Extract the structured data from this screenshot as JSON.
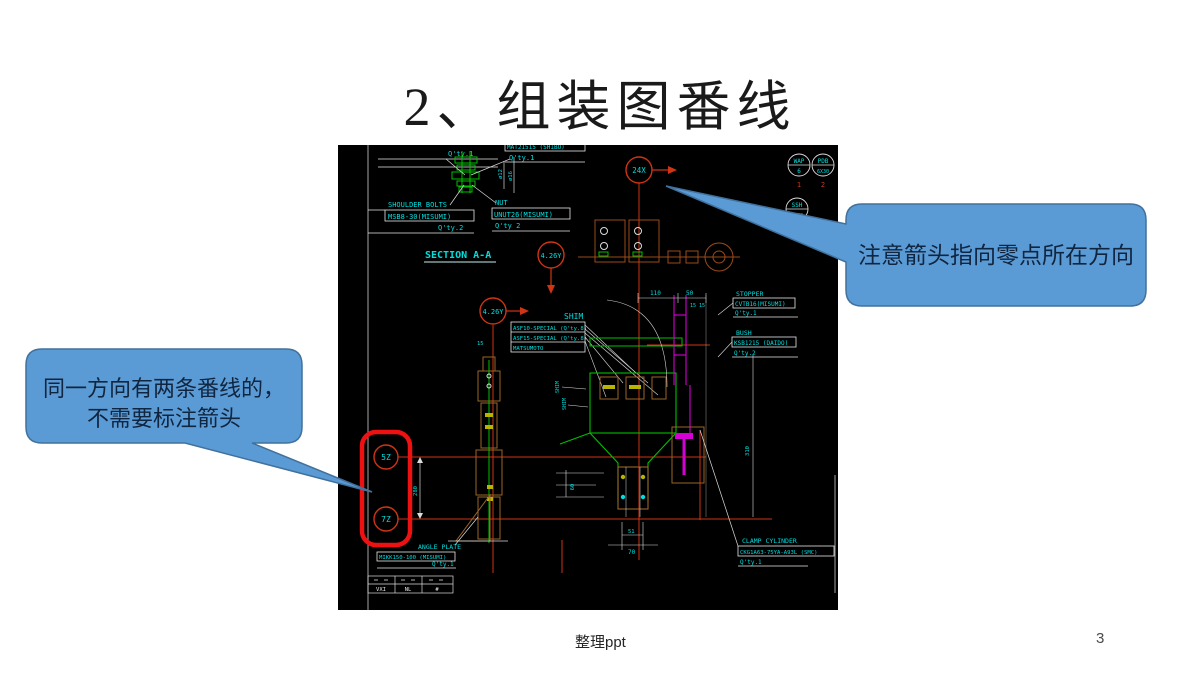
{
  "slide": {
    "title": "2、组装图番线",
    "footer_left": "整理ppt",
    "page_number": "3"
  },
  "callouts": {
    "fill": "#5b9bd5",
    "border": "#41719c",
    "right_text": "注意箭头指向零点所在方向",
    "left_line1": "同一方向有两条番线的，",
    "left_line2": "不需要标注箭头"
  },
  "cad": {
    "colors": {
      "cyan": "#00dede",
      "green": "#00c000",
      "red": "#cf3415",
      "highlight_red": "#ee1111",
      "magenta": "#d400d4",
      "tan": "#9a6428",
      "white": "#e8e8e8"
    },
    "section_label": "SECTION A-A",
    "top_left_qty": "Q'ty.1",
    "top_right_name": "MAT21515 (SHIBO)",
    "top_right_qty": "Q'ty.1",
    "shoulder_bolts": [
      "SHOULDER BOLTS",
      "MSB8-30(MISUMI)",
      "Q'ty.2"
    ],
    "nut": [
      "NUT",
      "UNUT26(MISUMI)",
      "Q'ty 2"
    ],
    "shim_title": "SHIM",
    "shim_rows": [
      "ASF10-SPECIAL (Q'ty.8)",
      "ASF15-SPECIAL (Q'ty.8)",
      "MATSUMOTO"
    ],
    "shim_v1": "SHIM",
    "shim_v2": "SHIM",
    "stopper": [
      "STOPPER",
      "CVTB16(MISUMI)",
      "Q'ty.1"
    ],
    "bush": [
      "BUSH",
      "KSB1215  (DAIDO)",
      "Q'ty.2"
    ],
    "clamp": [
      "CLAMP CYLINDER",
      "CKG1A63-75YA-A93L (SMC)",
      "Q'ty.1"
    ],
    "angle_plate": [
      "ANGLE PLATE",
      "MIKK150-100 (MISUMI)",
      "Q'ty.1"
    ],
    "balloons": {
      "b24x": "24X",
      "b426y_top": "4.26Y",
      "b426y_mid": "4.26Y",
      "z5": "5Z",
      "z7": "7Z"
    },
    "fasteners": [
      {
        "top": "WAP",
        "bottom": "6",
        "num": "1"
      },
      {
        "top": "PDB",
        "bottom": "6X30",
        "num": "2"
      },
      {
        "top": "SSH",
        "bottom": "N6C8",
        "num": ""
      }
    ],
    "dims": {
      "d110": "110",
      "d50": "50",
      "d15x2": "15 15",
      "d15": "15",
      "d280": "280",
      "d60": "60",
      "d51": "51",
      "d70": "70",
      "d310": "310",
      "d12": "ø12",
      "d16": "ø16"
    },
    "titleblock": [
      "VXI",
      "NL",
      "#"
    ]
  }
}
